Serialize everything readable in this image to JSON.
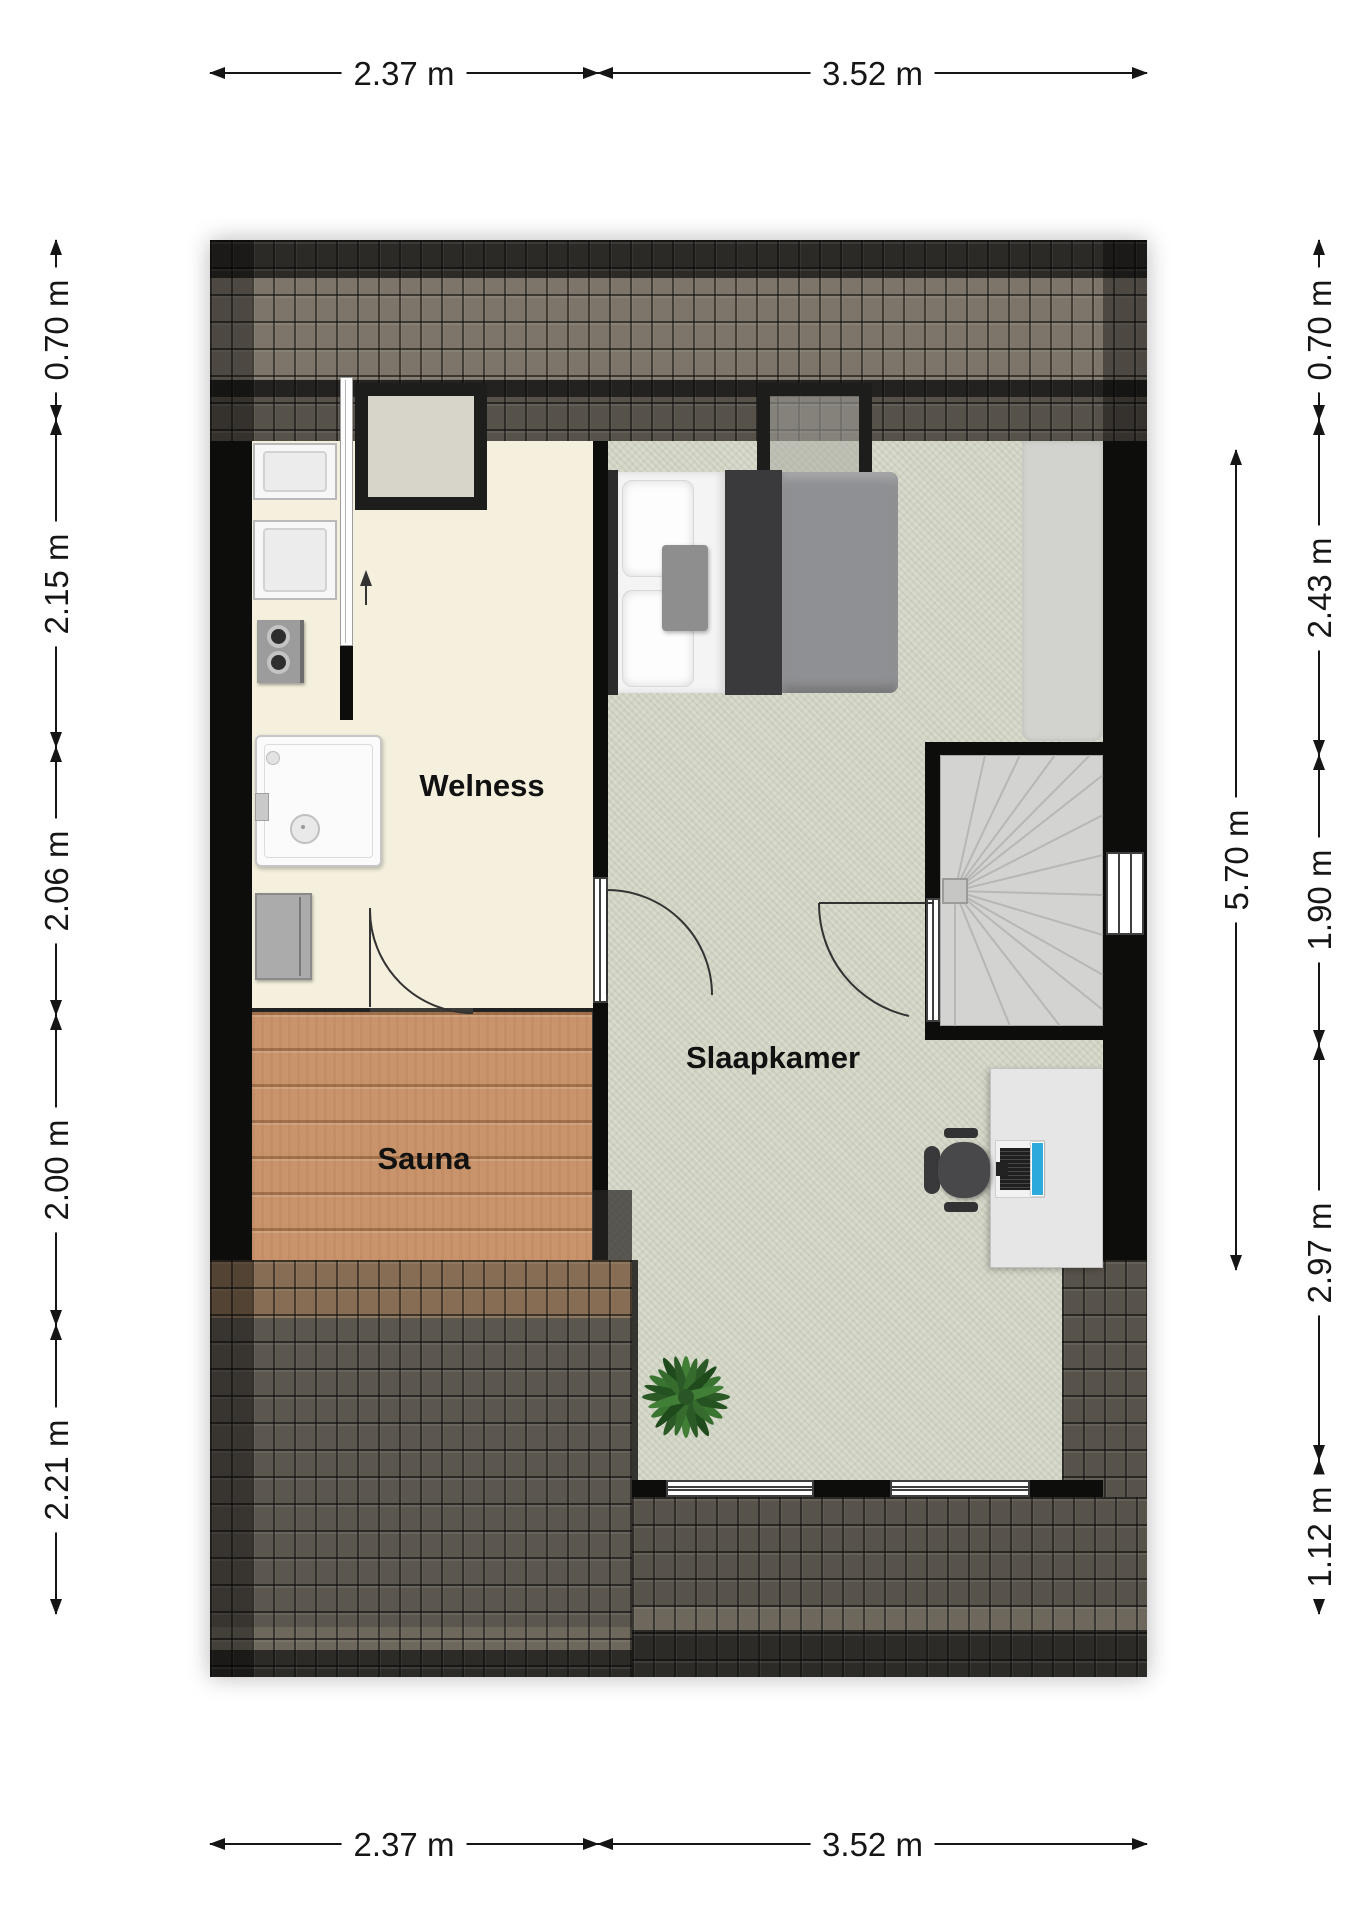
{
  "plan_title": "attic floor plan",
  "rooms": [
    {
      "name": "Welness"
    },
    {
      "name": "Sauna"
    },
    {
      "name": "Slaapkamer"
    }
  ],
  "dimensions": {
    "top": [
      "2.37 m",
      "3.52 m"
    ],
    "bottom": [
      "2.37 m",
      "3.52 m"
    ],
    "left": [
      "0.70 m",
      "2.15 m",
      "2.06 m",
      "2.00 m",
      "2.21 m"
    ],
    "right": [
      "0.70 m",
      "2.43 m",
      "1.90 m",
      "2.97 m",
      "1.12 m"
    ],
    "inner_right": "5.70 m"
  },
  "colors": {
    "wall": "#0d0d0c",
    "roof_tiles": "#55514a",
    "roof_light_band": "#7d7569",
    "welness_floor": "#f4f0dd",
    "sauna_floor": "#c9946b",
    "carpet": "#d8dbcc",
    "low_ceiling_zone": "#d2d2cf",
    "stairs": "#d3d3d1",
    "laptop_screen": "#2ea9dc",
    "plant": "#3a7431",
    "dimension_text": "#151515"
  },
  "icons": {
    "bed": "double-bed top view",
    "pillow": "rounded white rectangle",
    "chimney": "black framed square",
    "shower": "shower tray with drain plate",
    "washing_machine": "square appliance with door",
    "stove_knobs": "grey unit with two knobs",
    "cabinet": "grey cabinet",
    "stairs": "winder staircase fan treads",
    "window": "white bar with frame lines",
    "door_swing": "quarter-circle arc",
    "desk": "light grey rectangle",
    "office_chair": "dark grey chair top view",
    "laptop": "keyboard with blue screen",
    "plant": "green fern top view",
    "north_arrow": "small up arrow"
  }
}
